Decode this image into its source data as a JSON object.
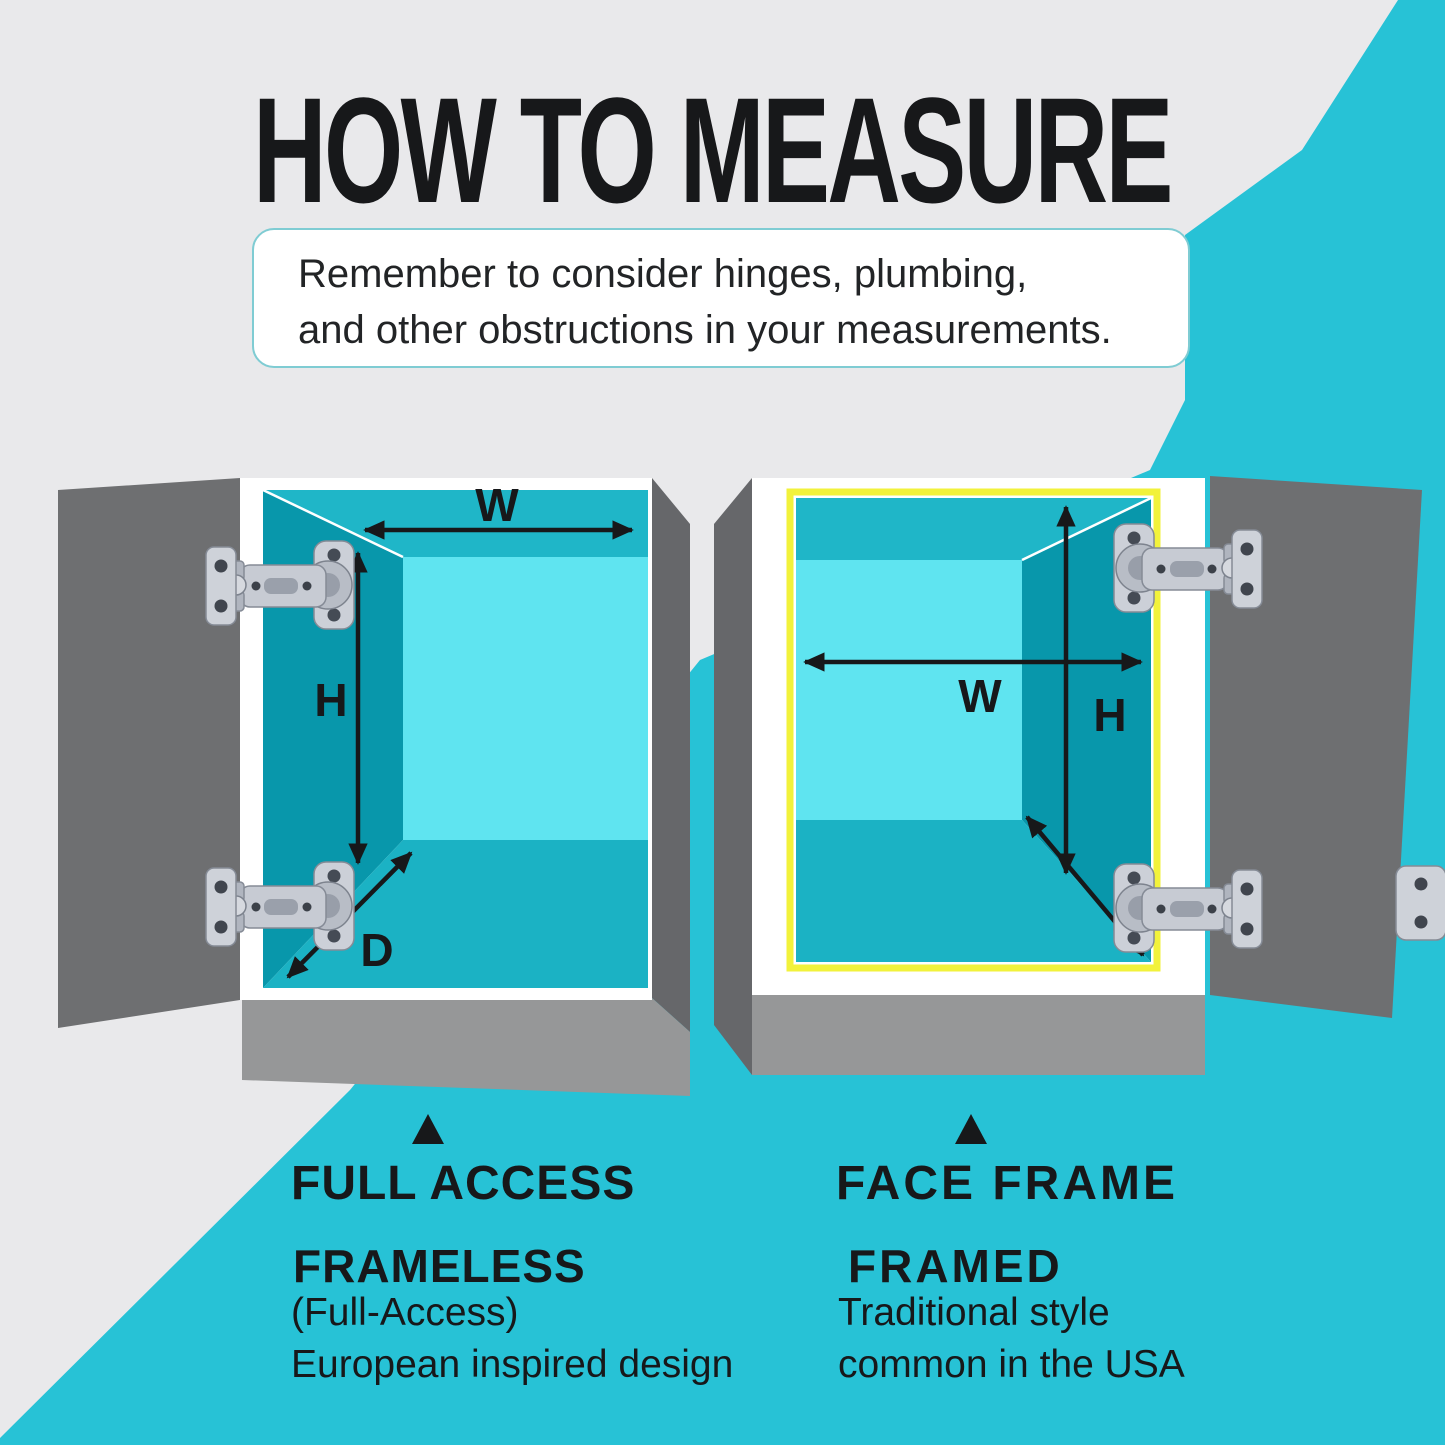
{
  "title": "HOW TO MEASURE",
  "note": {
    "line1": "Remember to consider hinges, plumbing,",
    "line2": "and other obstructions in your measurements."
  },
  "cabinets": {
    "left": {
      "labels": {
        "width": "W",
        "height": "H",
        "depth": "D"
      },
      "caption": "FULL ACCESS",
      "style_name": "FRAMELESS",
      "style_alt": "(Full-Access)",
      "style_desc": "European inspired design"
    },
    "right": {
      "labels": {
        "width": "W",
        "height": "H",
        "depth": "D"
      },
      "caption": "FACE FRAME",
      "style_name": "FRAMED",
      "style_desc1": "Traditional style",
      "style_desc2": "common in the USA"
    }
  },
  "colors": {
    "background": "#e9e9eb",
    "teal": "#27c2d6",
    "cabinet_white": "#ffffff",
    "door_gray": "#6e6f71",
    "side_gray": "#66676a",
    "base_gray": "#969798",
    "interior_ceiling": "#1fb6c8",
    "interior_floor": "#1bb2c4",
    "interior_side": "#0897ab",
    "interior_back": "#5fe4f0",
    "frame_yellow": "#f2f23b",
    "arrow_black": "#17181a",
    "note_border": "#7fccd3"
  }
}
